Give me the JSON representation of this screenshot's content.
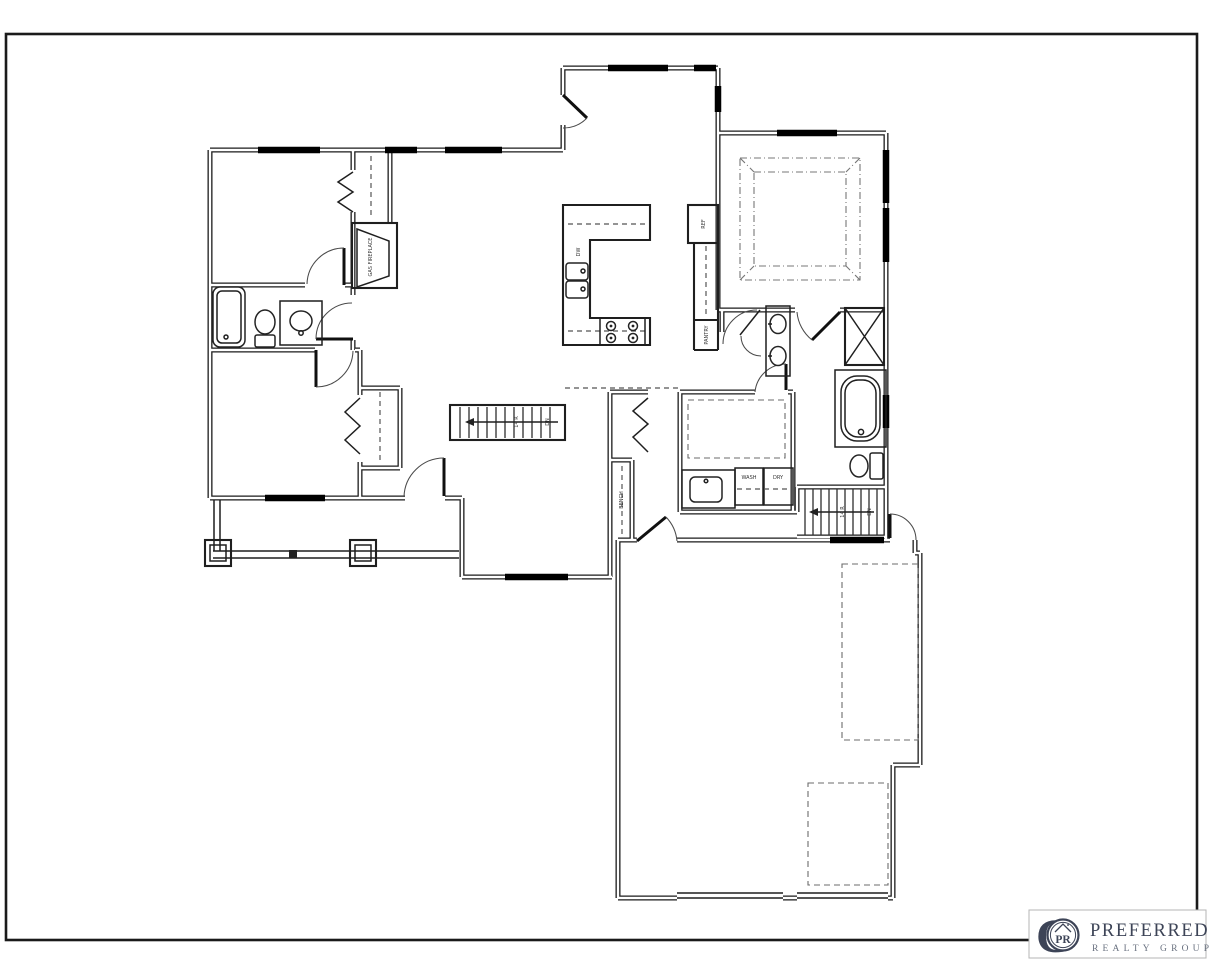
{
  "sheet": {
    "border_color": "#1a1a1a",
    "paper_color": "#ffffff"
  },
  "plan": {
    "labels": {
      "fireplace": "GAS FIREPLACE",
      "refrigerator": "REF",
      "pantry": "PANTRY",
      "dishwasher": "DW",
      "washer": "WASH",
      "dryer": "DRY",
      "bench": "BENCH",
      "main_stairs_risers": "14 R",
      "main_stairs_direction": "DN",
      "basement_stairs_risers": "14 R",
      "basement_stairs_direction": "DN"
    }
  },
  "logo": {
    "monogram_letter": "G",
    "monogram": "PR",
    "brand": "PREFERRED",
    "tagline": "REALTY GROUP",
    "primary_color": "#3d4457",
    "secondary_color": "#6a7280"
  }
}
